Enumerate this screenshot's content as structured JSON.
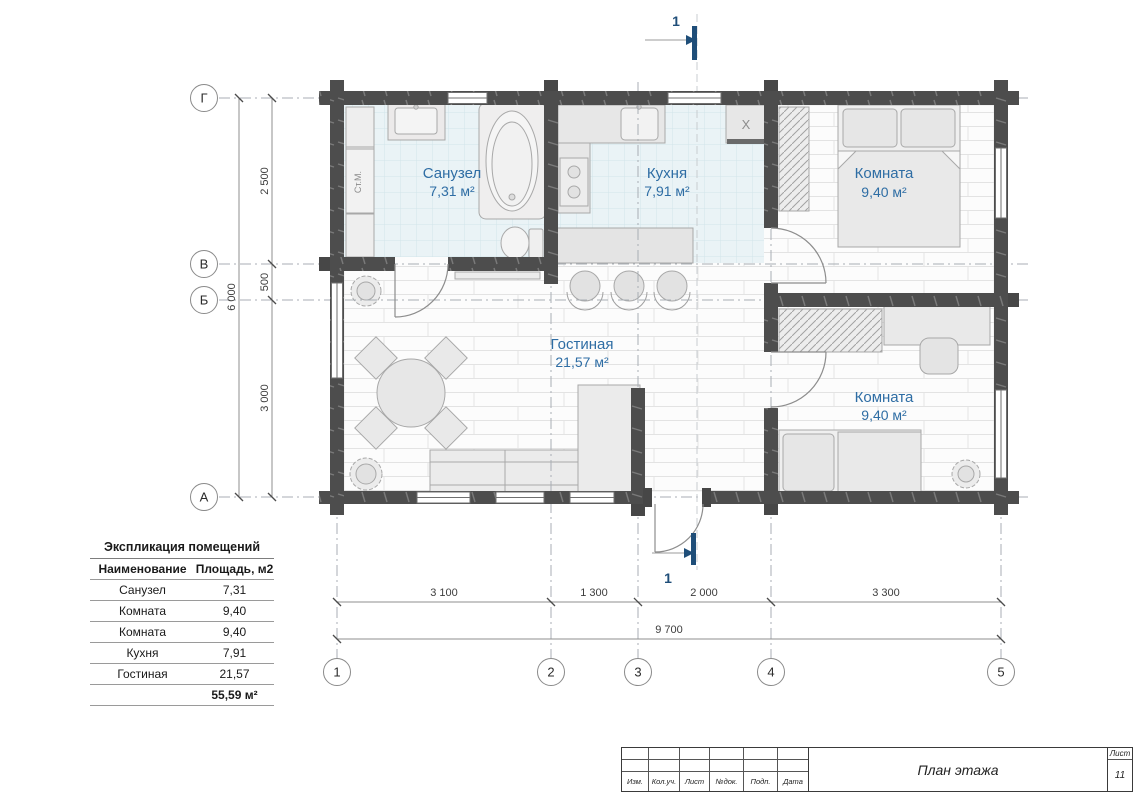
{
  "plan": {
    "section_marker": "1",
    "rooms": {
      "bathroom": {
        "name": "Санузел",
        "area": "7,31 м²"
      },
      "kitchen": {
        "name": "Кухня",
        "area": "7,91 м²"
      },
      "bedroom1": {
        "name": "Комната",
        "area": "9,40 м²"
      },
      "living": {
        "name": "Гостиная",
        "area": "21,57 м²"
      },
      "bedroom2": {
        "name": "Комната",
        "area": "9,40 м²"
      }
    },
    "labels": {
      "washing_machine": "Ст.М.",
      "fridge": "X"
    },
    "axes": {
      "horizontal": [
        "1",
        "2",
        "3",
        "4",
        "5"
      ],
      "vertical": [
        "Г",
        "В",
        "Б",
        "А"
      ]
    },
    "dimensions": {
      "bottom_segments": [
        "3 100",
        "1 300",
        "2 000",
        "3 300"
      ],
      "bottom_total": "9 700",
      "left_segments": [
        "2 500",
        "500",
        "3 000"
      ],
      "left_total": "6 000"
    }
  },
  "legend": {
    "title": "Экспликация помещений",
    "col_name": "Наименование",
    "col_area": "Площадь, м2",
    "rows": [
      {
        "name": "Санузел",
        "area": "7,31"
      },
      {
        "name": "Комната",
        "area": "9,40"
      },
      {
        "name": "Комната",
        "area": "9,40"
      },
      {
        "name": "Кухня",
        "area": "7,91"
      },
      {
        "name": "Гостиная",
        "area": "21,57"
      }
    ],
    "total": "55,59 м²"
  },
  "titleblock": {
    "cells": [
      "Изм.",
      "Кол.уч.",
      "Лист",
      "№док.",
      "Подп.",
      "Дата"
    ],
    "title": "План этажа",
    "sheet_label": "Лист",
    "sheet_number": "11"
  },
  "colors": {
    "wall": "#4d4d4d",
    "room_label": "#2e6da4",
    "section_marker": "#1f4e79",
    "tile_floor": "#eaf3f6",
    "grid_line": "#a8aeb4"
  }
}
